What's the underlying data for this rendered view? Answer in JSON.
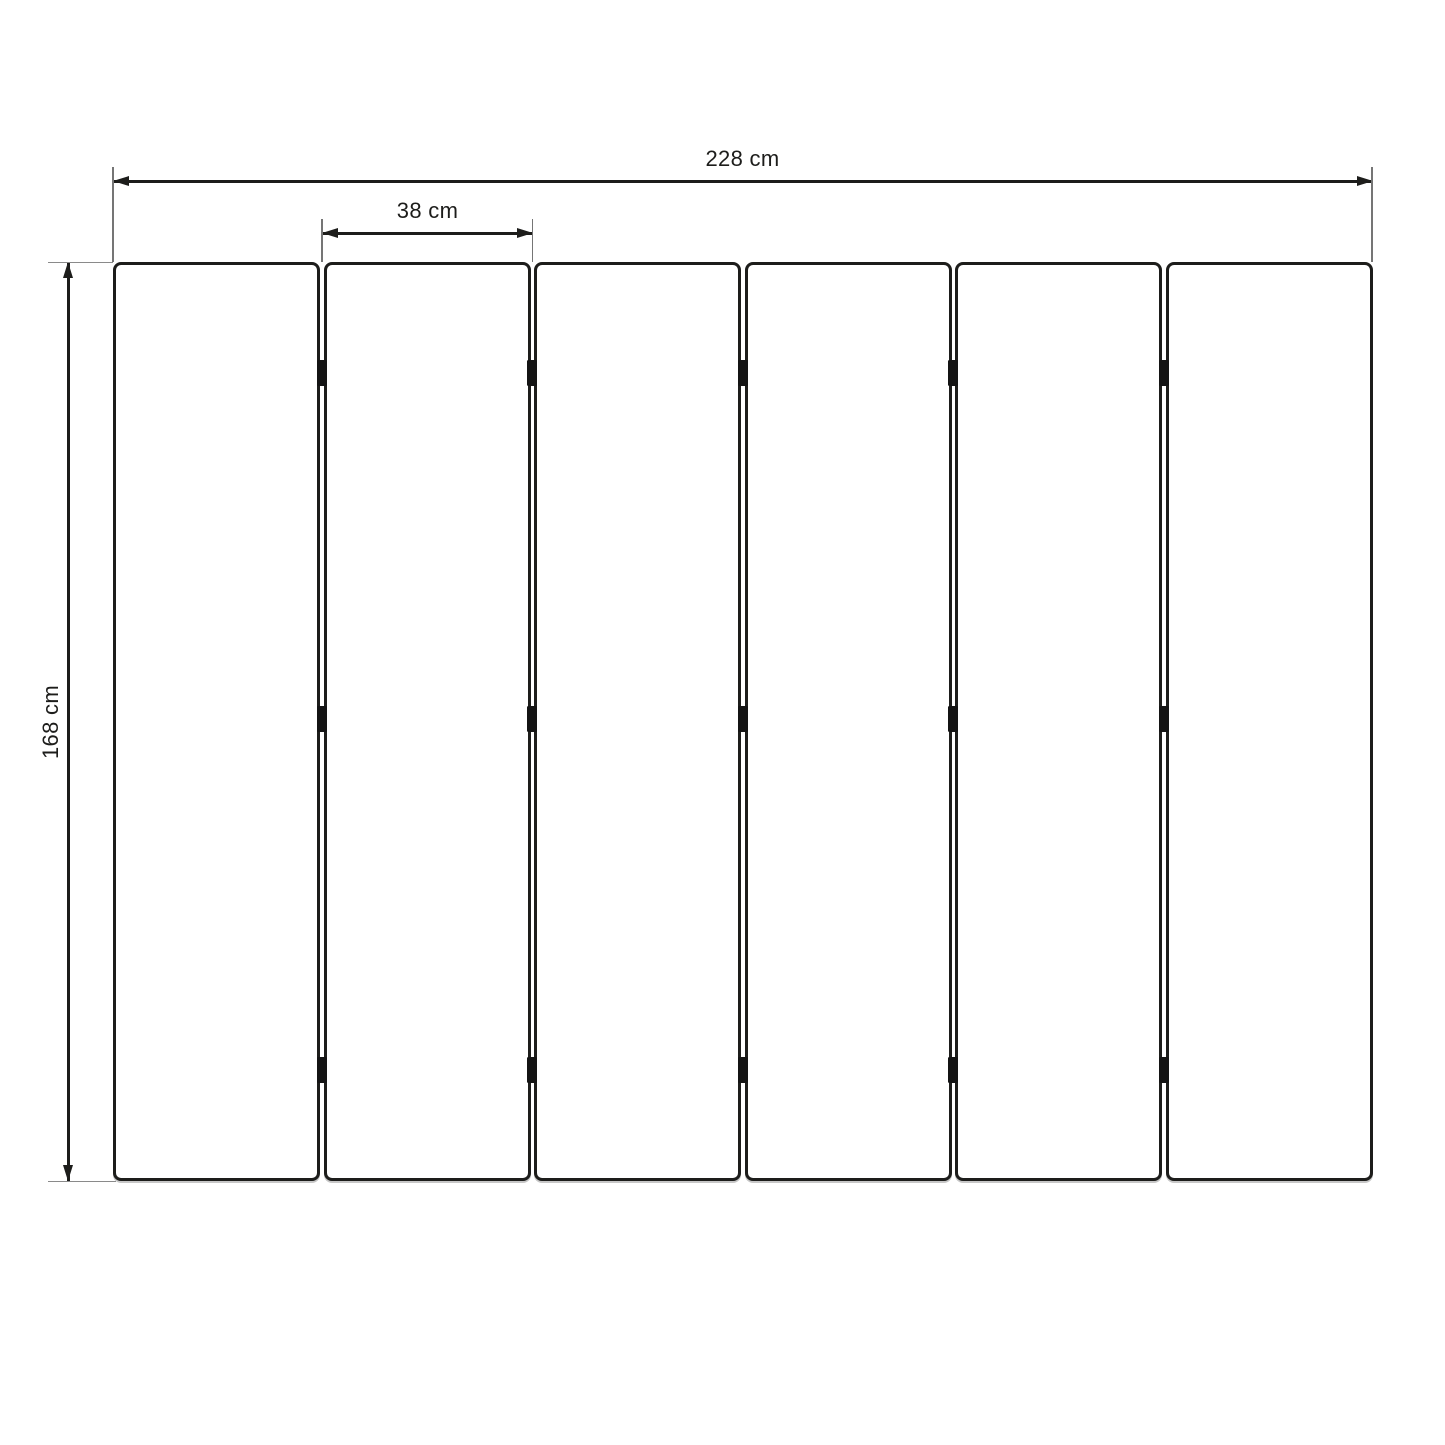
{
  "diagram": {
    "kind": "dimensioned technical drawing",
    "subject": "folding screen / room divider with hinged panels, front elevation",
    "dimensions": {
      "total_width": {
        "label": "228 cm",
        "value": 228,
        "unit": "cm"
      },
      "panel_width": {
        "label": "38 cm",
        "value": 38,
        "unit": "cm"
      },
      "height": {
        "label": "168 cm",
        "value": 168,
        "unit": "cm"
      }
    },
    "panels": {
      "count": 6,
      "joint_count": 5,
      "hinges_per_joint": 3
    },
    "colors": {
      "line": "#1d1d1b",
      "extension_line": "#7a7a7a",
      "hinge": "#141414",
      "panel_fill": "#ffffff",
      "background": "#ffffff"
    }
  }
}
